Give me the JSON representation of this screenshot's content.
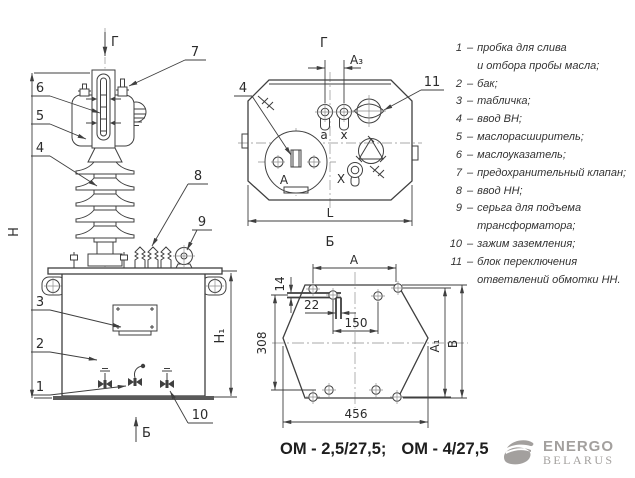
{
  "colors": {
    "line": "#3f3f3f",
    "text": "#2b2b2b",
    "logo_gray": "#a3a09e"
  },
  "front_view": {
    "view_label_top": "Г",
    "view_label_bottom": "Б",
    "dim_height_total": "H",
    "dim_height_tank": "H₁",
    "callouts": {
      "c1": "1",
      "c2": "2",
      "c3": "3",
      "c4": "4",
      "c5": "5",
      "c6": "6",
      "c7": "7",
      "c8": "8",
      "c9": "9",
      "c10": "10"
    }
  },
  "top_view": {
    "view_label": "Г",
    "bottom_label": "Б",
    "dim_span": "A₃",
    "dim_length": "L",
    "callout_hv_bushing": "4",
    "callout_switch_block": "11",
    "terminals": {
      "lv_a": "a",
      "lv_x": "x",
      "hv_A": "А",
      "hv_X": "X"
    }
  },
  "bottom_view": {
    "dim_a": "A",
    "dim_a1": "A₁",
    "dim_b": "B",
    "dim_14": "14",
    "dim_22": "22",
    "dim_150": "150",
    "dim_308": "308",
    "dim_456": "456"
  },
  "legend": {
    "dash": "–",
    "items": [
      {
        "num": "1",
        "text": "пробка для слива\nи отбора пробы масла;"
      },
      {
        "num": "2",
        "text": "бак;"
      },
      {
        "num": "3",
        "text": "табличка;"
      },
      {
        "num": "4",
        "text": "ввод ВН;"
      },
      {
        "num": "5",
        "text": "маслорасширитель;"
      },
      {
        "num": "6",
        "text": "маслоуказатель;"
      },
      {
        "num": "7",
        "text": "предохранительный клапан;"
      },
      {
        "num": "8",
        "text": "ввод НН;"
      },
      {
        "num": "9",
        "text": "серьга для подъема\nтрансформатора;"
      },
      {
        "num": "10",
        "text": "зажим заземления;"
      },
      {
        "num": "11",
        "text": "блок переключения\nответвлений обмотки НН."
      }
    ]
  },
  "caption": {
    "model_1": "ОМ - 2,5/27,5;",
    "model_2": "ОМ - 4/27,5"
  },
  "logo": {
    "line1": "ENERGO",
    "line2": "BELARUS"
  }
}
